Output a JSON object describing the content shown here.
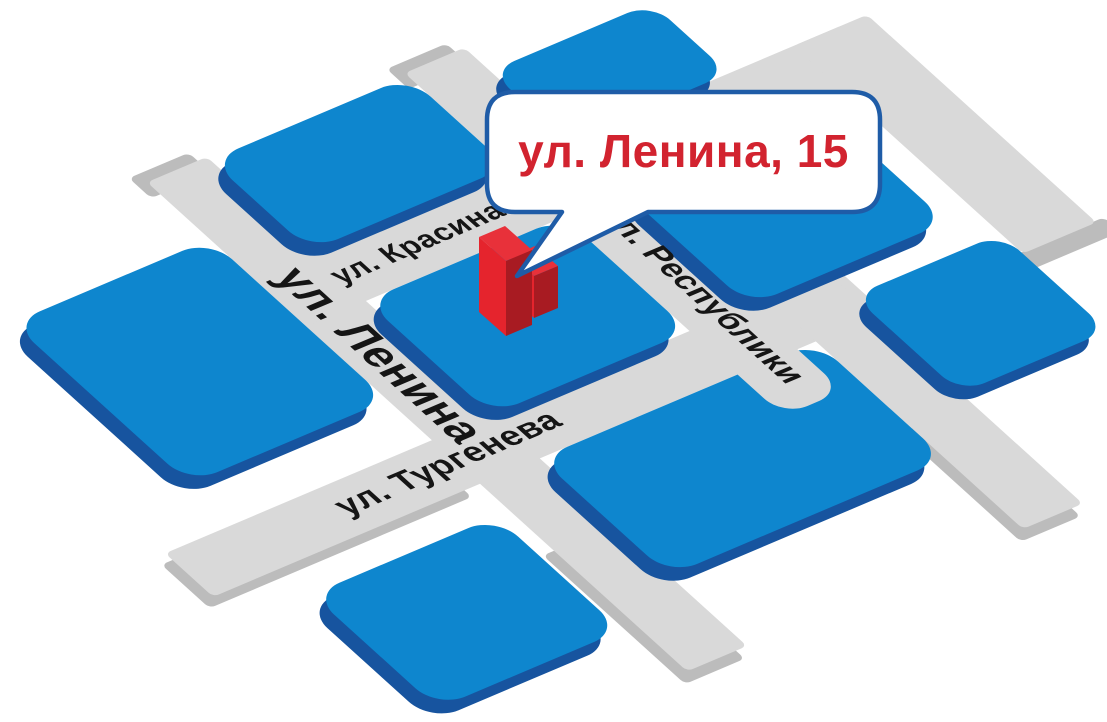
{
  "map": {
    "type": "isometric-address-map",
    "callout": {
      "address": "ул. Ленина, 15"
    },
    "streets": {
      "lenina": "ул. Ленина",
      "krasina": "ул. Красина",
      "respubliki": "ул. Республики",
      "turgeneva": "ул. Тургенева"
    },
    "blocks_count": 8,
    "marker": {
      "kind": "red-3d-building",
      "location_street": "ул. Ленина"
    },
    "colors": {
      "block_top": "#0E86CE",
      "block_side": "#17549F",
      "street": "#D9D9D9",
      "street_edge": "#BCBCBC",
      "marker_front": "#E5242D",
      "marker_side": "#A81B22",
      "marker_top": "#E8313A",
      "callout_border": "#1F5CA7",
      "callout_text_color": "#D2232F",
      "label_text": "#151515",
      "background": "#FFFFFF"
    }
  }
}
